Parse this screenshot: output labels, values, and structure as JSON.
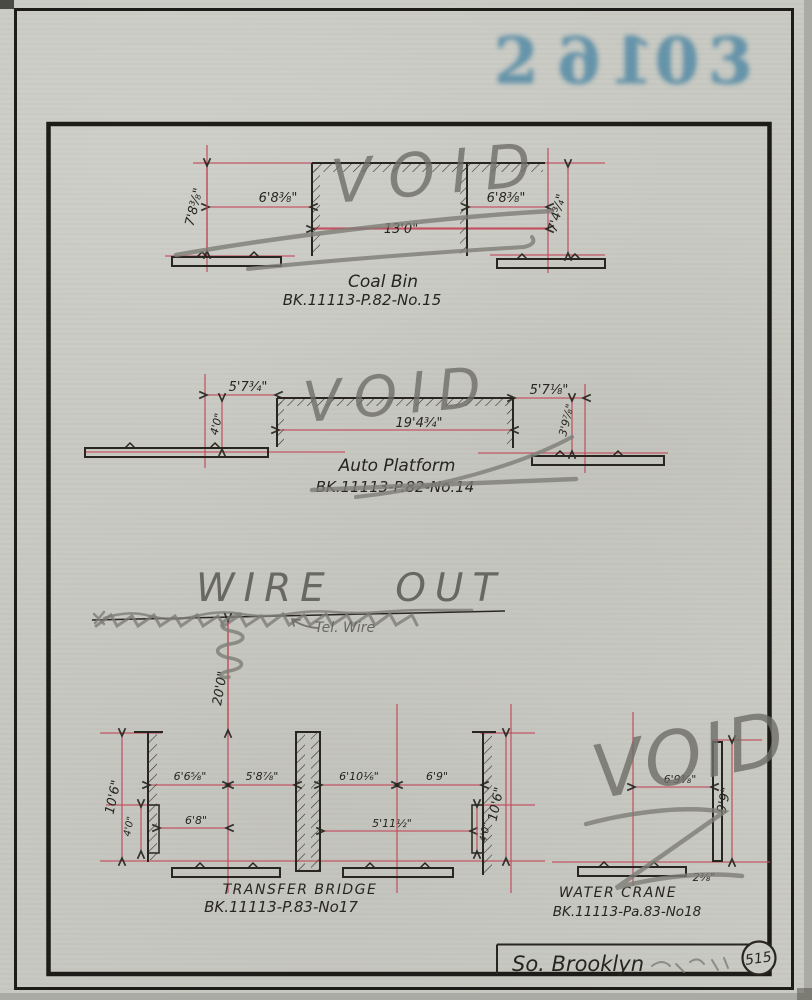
{
  "stamp": {
    "number": "26103"
  },
  "coal_bin": {
    "title": "Coal Bin",
    "ref": "BK.11113-P.82-No.15",
    "void": "VOID",
    "dim_height_left": "7'8⅜\"",
    "dim_offset_left": "6'8⅜\"",
    "dim_width": "13'0\"",
    "dim_offset_right": "6'8⅜\"",
    "dim_height_right": "7'4¾\""
  },
  "auto_platform": {
    "title": "Auto Platform",
    "ref": "BK.11113-P.82-No.14",
    "void": "VOID",
    "dim_offset_left": "5'7¾\"",
    "dim_height_left": "4'0\"",
    "dim_width": "19'4¾\"",
    "dim_offset_right": "5'7⅛\"",
    "dim_height_right": "3'9⅞\""
  },
  "wire": {
    "note": "WIRE OUT",
    "wire_label": "Tel. Wire",
    "dim_height": "20'0\""
  },
  "transfer_bridge": {
    "title": "TRANSFER BRIDGE",
    "ref": "BK.11113-P.83-No17",
    "dim_height_left": "10'6\"",
    "dim_step_left": "4'0\"",
    "dim_span_1": "6'6⅝\"",
    "dim_span_2": "5'8⅞\"",
    "dim_span_3": "6'10⅙\"",
    "dim_span_4": "6'9\"",
    "dim_lower_left": "6'8\"",
    "dim_lower_right": "5'11½\"",
    "dim_step_right": "4'0\"",
    "dim_height_right": "10'6\""
  },
  "water_crane": {
    "title": "WATER CRANE",
    "ref": "BK.11113-Pa.83-No18",
    "void": "VOID",
    "dim_offset": "6'9⅜\"",
    "dim_height": "9'9\"",
    "dim_base": "2⅜\""
  },
  "footer": {
    "location": "So. Brooklyn",
    "page_number": "515"
  }
}
